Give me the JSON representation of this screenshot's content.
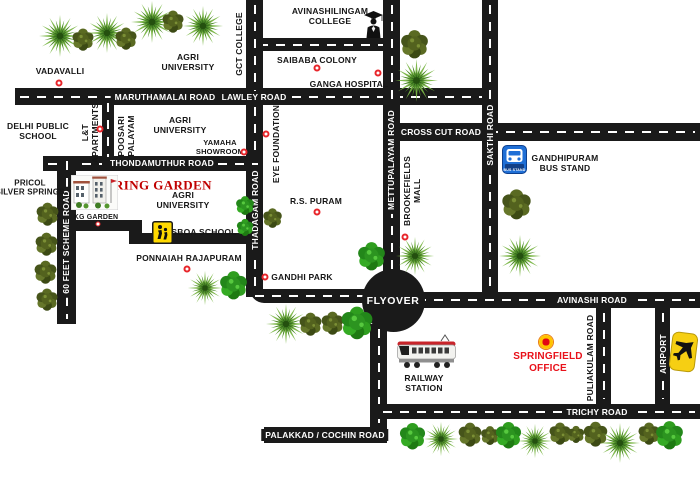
{
  "map": {
    "background": "#ffffff",
    "road_color": "#1a1a1a",
    "dash_color": "#ffffff",
    "marker_color": "#e8262b",
    "brand_red": "#c00000",
    "office_red": "#e8111a",
    "roads": [
      {
        "name": "maruthamalai-lawley-road",
        "x": 15,
        "y": 88,
        "w": 475,
        "h": 17,
        "o": "h",
        "dashed": true
      },
      {
        "name": "avinashilingam-college-road",
        "x": 254,
        "y": 38,
        "w": 146,
        "h": 13,
        "o": "h",
        "dashed": true
      },
      {
        "name": "gct-thadagam-road",
        "x": 246,
        "y": 0,
        "w": 17,
        "h": 297,
        "o": "v",
        "dashed": true
      },
      {
        "name": "gandhi-park-road",
        "x": 250,
        "y": 289,
        "w": 120,
        "h": 14,
        "o": "h",
        "dashed": true,
        "r": "0 0 0 14px"
      },
      {
        "name": "mettupalayam-road",
        "x": 383,
        "y": 0,
        "w": 17,
        "h": 276,
        "o": "v",
        "dashed": true
      },
      {
        "name": "sakthi-road",
        "x": 482,
        "y": 0,
        "w": 16,
        "h": 295,
        "o": "v",
        "dashed": true
      },
      {
        "name": "cross-cut-road",
        "x": 399,
        "y": 123,
        "w": 301,
        "h": 18,
        "o": "h",
        "dashed": true
      },
      {
        "name": "thondamuthur-road",
        "x": 43,
        "y": 156,
        "w": 220,
        "h": 15,
        "o": "h",
        "dashed": true
      },
      {
        "name": "sixty-feet-scheme-road",
        "x": 57,
        "y": 156,
        "w": 19,
        "h": 168,
        "o": "v",
        "dashed": true
      },
      {
        "name": "lnt-apartments-road",
        "x": 102,
        "y": 98,
        "w": 12,
        "h": 68,
        "o": "v",
        "dashed": true
      },
      {
        "name": "kg-garden-road",
        "x": 57,
        "y": 220,
        "w": 85,
        "h": 11,
        "o": "h",
        "dashed": false
      },
      {
        "name": "kg-garden-road-jog",
        "x": 129,
        "y": 220,
        "w": 13,
        "h": 24,
        "o": "v",
        "dashed": false
      },
      {
        "name": "sboa-school-road",
        "x": 129,
        "y": 233,
        "w": 128,
        "h": 11,
        "o": "h",
        "dashed": false
      },
      {
        "name": "avinashi-road",
        "x": 412,
        "y": 292,
        "w": 288,
        "h": 16,
        "o": "h",
        "dashed": true
      },
      {
        "name": "railway-station-road",
        "x": 370,
        "y": 324,
        "w": 17,
        "h": 119,
        "o": "v",
        "dashed": true
      },
      {
        "name": "trichy-road",
        "x": 378,
        "y": 404,
        "w": 322,
        "h": 15,
        "o": "h",
        "dashed": true
      },
      {
        "name": "palakkad-cochin-road",
        "x": 264,
        "y": 427,
        "w": 123,
        "h": 16,
        "o": "h",
        "dashed": false
      },
      {
        "name": "puliakulam-road",
        "x": 596,
        "y": 308,
        "w": 15,
        "h": 96,
        "o": "v",
        "dashed": true
      },
      {
        "name": "airport-road",
        "x": 655,
        "y": 308,
        "w": 15,
        "h": 96,
        "o": "v",
        "dashed": true
      },
      {
        "name": "flyover-junction",
        "x": 362,
        "y": 269,
        "w": 63,
        "h": 63,
        "o": "c",
        "circle": true
      }
    ],
    "labels": [
      {
        "name": "maruthamalai-road-label",
        "text": "MARUTHAMALAI ROAD",
        "x": 165,
        "y": 97,
        "cls": "label--road"
      },
      {
        "name": "lawley-road-label",
        "text": "LAWLEY ROAD",
        "x": 254,
        "y": 97,
        "cls": "label--road"
      },
      {
        "name": "cross-cut-road-label",
        "text": "CROSS CUT ROAD",
        "x": 441,
        "y": 132,
        "cls": "label--road"
      },
      {
        "name": "thondamuthur-road-label",
        "text": "THONDAMUTHUR ROAD",
        "x": 162,
        "y": 163,
        "cls": "label--road"
      },
      {
        "name": "avinashi-road-label",
        "text": "AVINASHI ROAD",
        "x": 592,
        "y": 300,
        "cls": "label--road"
      },
      {
        "name": "trichy-road-label",
        "text": "TRICHY ROAD",
        "x": 597,
        "y": 412,
        "cls": "label--road"
      },
      {
        "name": "palakkad-cochin-road-label",
        "text": "PALAKKAD / COCHIN ROAD",
        "x": 325,
        "y": 435,
        "cls": "label--road"
      },
      {
        "name": "flyover-label",
        "text": "FLYOVER",
        "x": 393,
        "y": 301,
        "cls": "label--road label--flyover"
      },
      {
        "name": "mettupalayam-road-label",
        "text": "METTUPALAYAM ROAD",
        "x": 391,
        "y": 160,
        "cls": "label--road label--vert"
      },
      {
        "name": "sakthi-road-label",
        "text": "SAKTHI ROAD",
        "x": 490,
        "y": 135,
        "cls": "label--road label--vert"
      },
      {
        "name": "thadagam-road-label",
        "text": "THADAGAM ROAD",
        "x": 255,
        "y": 210,
        "cls": "label--road label--vert"
      },
      {
        "name": "sixty-feet-scheme-road-label",
        "text": "60 FEET SCHEME ROAD",
        "x": 66,
        "y": 242,
        "cls": "label--road label--vert"
      },
      {
        "name": "airport-road-label",
        "text": "AIRPORT",
        "x": 663,
        "y": 354,
        "cls": "label--road label--vert"
      },
      {
        "name": "vadavalli-label",
        "text": "VADAVALLI",
        "x": 60,
        "y": 71
      },
      {
        "name": "agri-university-north-label",
        "text": "AGRI\nUNIVERSITY",
        "x": 188,
        "y": 62
      },
      {
        "name": "gct-college-label",
        "text": "GCT COLLEGE",
        "x": 239,
        "y": 44,
        "cls": "label--vert-plain"
      },
      {
        "name": "avinashilingam-college-label",
        "text": "AVINASHILINGAM\nCOLLEGE",
        "x": 330,
        "y": 16
      },
      {
        "name": "saibaba-colony-label",
        "text": "SAIBABA COLONY",
        "x": 317,
        "y": 60
      },
      {
        "name": "ganga-hospital-label",
        "text": "GANGA HOSPITAL",
        "x": 349,
        "y": 84
      },
      {
        "name": "delhi-public-school-label",
        "text": "DELHI PUBLIC\nSCHOOL",
        "x": 38,
        "y": 131
      },
      {
        "name": "lnt-apartments-label",
        "text": "L&T\nAPARTMENTS",
        "x": 90,
        "y": 133,
        "cls": "label--vert-plain"
      },
      {
        "name": "poosari-palayam-label",
        "text": "POOSARI\nPALAYAM",
        "x": 126,
        "y": 136,
        "cls": "label--vert-plain"
      },
      {
        "name": "agri-university-mid-label",
        "text": "AGRI\nUNIVERSITY",
        "x": 180,
        "y": 125
      },
      {
        "name": "yamaha-showroom-label",
        "text": "YAMAHA\nSHOWROOM",
        "x": 220,
        "y": 148,
        "fs": 7.5
      },
      {
        "name": "eye-foundation-label",
        "text": "EYE FOUNDATION",
        "x": 276,
        "y": 144,
        "cls": "label--vert-plain"
      },
      {
        "name": "gandhipuram-bus-stand-label",
        "text": "GANDHIPURAM\nBUS STAND",
        "x": 565,
        "y": 163
      },
      {
        "name": "pricol-silver-springs-label",
        "text": "PRICOL\nSILVER SPRINGS",
        "x": 30,
        "y": 188,
        "fs": 8
      },
      {
        "name": "spring-garden-label",
        "text": "SPRING GARDEN",
        "x": 155,
        "y": 185,
        "cls": "label--brand"
      },
      {
        "name": "agri-university-south-label",
        "text": "AGRI\nUNIVERSITY",
        "x": 183,
        "y": 200
      },
      {
        "name": "kg-garden-label",
        "text": "KG GARDEN",
        "x": 96,
        "y": 218,
        "fs": 7
      },
      {
        "name": "sboa-school-label",
        "text": "SBOA SCHOOL",
        "x": 204,
        "y": 232
      },
      {
        "name": "rs-puram-label",
        "text": "R.S. PURAM",
        "x": 316,
        "y": 201
      },
      {
        "name": "brookefields-mall-label",
        "text": "BROOKEFIELDS\nMALL",
        "x": 412,
        "y": 191,
        "cls": "label--vert-plain"
      },
      {
        "name": "ponnaiah-rajapuram-label",
        "text": "PONNAIAH RAJAPURAM",
        "x": 189,
        "y": 258
      },
      {
        "name": "gandhi-park-label",
        "text": "GANDHI PARK",
        "x": 302,
        "y": 277
      },
      {
        "name": "railway-station-label",
        "text": "RAILWAY\nSTATION",
        "x": 424,
        "y": 383
      },
      {
        "name": "springfield-office-label",
        "text": "SPRINGFIELD\nOFFICE",
        "x": 548,
        "y": 363,
        "cls": "label--red"
      },
      {
        "name": "puliakulam-road-label",
        "text": "PULIAKULAM ROAD",
        "x": 590,
        "y": 358,
        "cls": "label--vert-plain"
      }
    ],
    "markers": [
      {
        "name": "vadavalli-marker",
        "x": 59,
        "y": 83,
        "kind": "dot"
      },
      {
        "name": "saibaba-colony-marker",
        "x": 317,
        "y": 68,
        "kind": "dot"
      },
      {
        "name": "ganga-hospital-marker",
        "x": 378,
        "y": 73,
        "kind": "dot"
      },
      {
        "name": "lnt-apartments-marker",
        "x": 100,
        "y": 129,
        "kind": "dot"
      },
      {
        "name": "yamaha-showroom-marker",
        "x": 244,
        "y": 152,
        "kind": "dot"
      },
      {
        "name": "eye-foundation-marker",
        "x": 266,
        "y": 134,
        "kind": "dot"
      },
      {
        "name": "kg-garden-marker",
        "x": 98,
        "y": 224,
        "kind": "small"
      },
      {
        "name": "rs-puram-marker",
        "x": 317,
        "y": 212,
        "kind": "dot"
      },
      {
        "name": "brookefields-mall-marker",
        "x": 405,
        "y": 237,
        "kind": "dot"
      },
      {
        "name": "ponnaiah-rajapuram-marker",
        "x": 187,
        "y": 269,
        "kind": "dot"
      },
      {
        "name": "gandhi-park-marker",
        "x": 265,
        "y": 277,
        "kind": "dot"
      },
      {
        "name": "springfield-office-marker",
        "x": 546,
        "y": 342,
        "kind": "big"
      }
    ],
    "icons": [
      {
        "name": "graduate-icon",
        "type": "grad",
        "x": 363,
        "y": 11,
        "w": 21,
        "h": 27
      },
      {
        "name": "bus-stand-icon",
        "type": "bus",
        "x": 502,
        "y": 145,
        "w": 25,
        "h": 29,
        "label": "BUS STAND"
      },
      {
        "name": "school-crossing-icon",
        "type": "sboa",
        "x": 152,
        "y": 221,
        "w": 21,
        "h": 23
      },
      {
        "name": "train-icon",
        "type": "train",
        "x": 396,
        "y": 333,
        "w": 61,
        "h": 37
      },
      {
        "name": "airplane-icon",
        "type": "plane",
        "x": 669,
        "y": 330,
        "w": 30,
        "h": 45
      },
      {
        "name": "spring-garden-photo",
        "type": "building",
        "x": 71,
        "y": 175,
        "w": 47,
        "h": 35
      }
    ],
    "trees": [
      {
        "t": "l",
        "x": 38,
        "y": 14,
        "s": 44
      },
      {
        "t": "o",
        "x": 70,
        "y": 26,
        "s": 26
      },
      {
        "t": "l",
        "x": 86,
        "y": 12,
        "s": 42
      },
      {
        "t": "o",
        "x": 113,
        "y": 25,
        "s": 26
      },
      {
        "t": "l",
        "x": 130,
        "y": 0,
        "s": 44
      },
      {
        "t": "o",
        "x": 160,
        "y": 8,
        "s": 26
      },
      {
        "t": "l",
        "x": 182,
        "y": 5,
        "s": 42
      },
      {
        "t": "o",
        "x": 398,
        "y": 27,
        "s": 33
      },
      {
        "t": "l",
        "x": 394,
        "y": 58,
        "s": 45
      },
      {
        "t": "o",
        "x": 34,
        "y": 200,
        "s": 27
      },
      {
        "t": "o",
        "x": 33,
        "y": 230,
        "s": 27
      },
      {
        "t": "o",
        "x": 32,
        "y": 258,
        "s": 27
      },
      {
        "t": "o",
        "x": 34,
        "y": 286,
        "s": 26
      },
      {
        "t": "b",
        "x": 234,
        "y": 194,
        "s": 22
      },
      {
        "t": "b",
        "x": 235,
        "y": 217,
        "s": 20
      },
      {
        "t": "o",
        "x": 261,
        "y": 206,
        "s": 23
      },
      {
        "t": "l",
        "x": 187,
        "y": 270,
        "s": 36
      },
      {
        "t": "b",
        "x": 217,
        "y": 268,
        "s": 33
      },
      {
        "t": "l",
        "x": 265,
        "y": 303,
        "s": 42
      },
      {
        "t": "o",
        "x": 297,
        "y": 310,
        "s": 27
      },
      {
        "t": "o",
        "x": 319,
        "y": 309,
        "s": 27
      },
      {
        "t": "b",
        "x": 338,
        "y": 303,
        "s": 38
      },
      {
        "t": "b",
        "x": 355,
        "y": 239,
        "s": 33
      },
      {
        "t": "l",
        "x": 395,
        "y": 236,
        "s": 40
      },
      {
        "t": "l",
        "x": 498,
        "y": 234,
        "s": 44
      },
      {
        "t": "o",
        "x": 499,
        "y": 186,
        "s": 35
      },
      {
        "t": "b",
        "x": 397,
        "y": 420,
        "s": 31
      },
      {
        "t": "l",
        "x": 423,
        "y": 421,
        "s": 36
      },
      {
        "t": "o",
        "x": 456,
        "y": 420,
        "s": 28
      },
      {
        "t": "o",
        "x": 479,
        "y": 424,
        "s": 22
      },
      {
        "t": "b",
        "x": 493,
        "y": 419,
        "s": 31
      },
      {
        "t": "l",
        "x": 517,
        "y": 423,
        "s": 36
      },
      {
        "t": "o",
        "x": 547,
        "y": 420,
        "s": 26
      },
      {
        "t": "o",
        "x": 566,
        "y": 424,
        "s": 20
      },
      {
        "t": "o",
        "x": 581,
        "y": 419,
        "s": 29
      },
      {
        "t": "l",
        "x": 599,
        "y": 422,
        "s": 42
      },
      {
        "t": "o",
        "x": 636,
        "y": 420,
        "s": 26
      },
      {
        "t": "b",
        "x": 653,
        "y": 418,
        "s": 33
      }
    ]
  }
}
